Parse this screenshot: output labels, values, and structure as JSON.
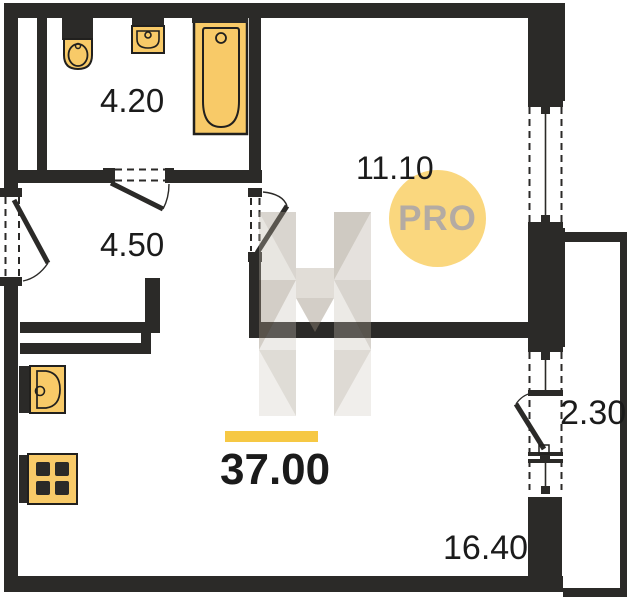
{
  "labels": {
    "bathroom_area": "4.20",
    "hallway_area": "4.50",
    "living_room_area": "11.10",
    "balcony_area": "2.30",
    "kitchen_living_area": "16.40",
    "total_area": "37.00",
    "watermark_badge": "PRO"
  },
  "colors": {
    "wall": "#2b2a28",
    "fixture_fill": "#f8ca68",
    "fixture_outline": "#21201e",
    "accent_bar": "#f6c844",
    "pro_circle": "#fad77e",
    "pro_text": "#b4aba3",
    "label_ink": "#1b1b1b"
  },
  "fixtures": [
    {
      "name": "toilet"
    },
    {
      "name": "wash-basin"
    },
    {
      "name": "bathtub"
    },
    {
      "name": "kitchen-sink"
    },
    {
      "name": "stove"
    }
  ]
}
